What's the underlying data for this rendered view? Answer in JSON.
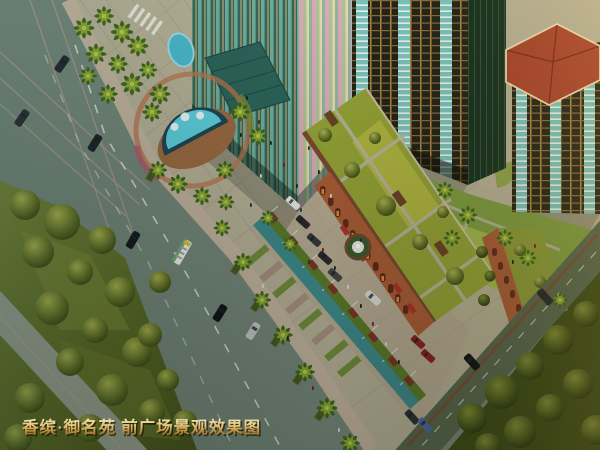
{
  "caption": {
    "text": "香缤·御名苑 前广场景观效果图"
  },
  "palette": {
    "road": "#74877a",
    "road_dark": "#55654e",
    "side_road": "#99a292",
    "lane_marking_white": "#e8ece6",
    "lane_marking_pink": "#d8a4a4",
    "park_grass": "#5a6a24",
    "park_grass_dark": "#3a4916",
    "plaza_paving": "#b6b096",
    "fountain_water": "#5ecfdc",
    "fountain_deck": "#9a6a40",
    "glass_tower_teal": "#35685c",
    "entrance_canopy": "#2c645a",
    "tower_frame_gold": "#b08a44",
    "balcony_glass": "#7cc4bc",
    "red_hip_roof": "#a8432d",
    "terracotta_facade": "#a85c36",
    "retail_glass": "#3e8a8c",
    "roof_garden": "#93a236",
    "caption_gold": "#e2c274"
  },
  "scene": {
    "type": "aerial architectural rendering of a front plaza",
    "objects": [
      {
        "id": "main-road",
        "desc": "diagonal avenue with white dashed lanes, sedans and a bus"
      },
      {
        "id": "cross-road-markings",
        "desc": "intersection with pink lane lines, top-left"
      },
      {
        "id": "zebra-crossing",
        "desc": "white crosswalk stripes near top"
      },
      {
        "id": "park-southwest",
        "desc": "large lawn with tree clusters"
      },
      {
        "id": "park-southeast",
        "desc": "dark wooded park, bottom-right"
      },
      {
        "id": "front-plaza-fountain",
        "desc": "D-shaped pool with wooden deck and flower arcs"
      },
      {
        "id": "glass-office-tower",
        "desc": "teal curtain-wall high-rise with entrance canopy"
      },
      {
        "id": "residential-tower-east",
        "desc": "gold-frame tower with teal balconies"
      },
      {
        "id": "residential-tower-red-roof",
        "desc": "tower topped by red hip roof"
      },
      {
        "id": "retail-row-glass",
        "desc": "teal glass shop row with planted roof"
      },
      {
        "id": "retail-row-terracotta",
        "desc": "arched terracotta shop blocks with roof gardens"
      },
      {
        "id": "roof-garden",
        "desc": "sloped roof garden band with crossing paths"
      },
      {
        "id": "courtyard-amphitheater",
        "desc": "circular stepped plaza in courtyard"
      },
      {
        "id": "street-fountain",
        "desc": "small round fountain in shopping street"
      },
      {
        "id": "palm-trees",
        "desc": "palm groves along plaza and sidewalks"
      },
      {
        "id": "pedestrians",
        "desc": "small figures across plaza"
      }
    ]
  }
}
